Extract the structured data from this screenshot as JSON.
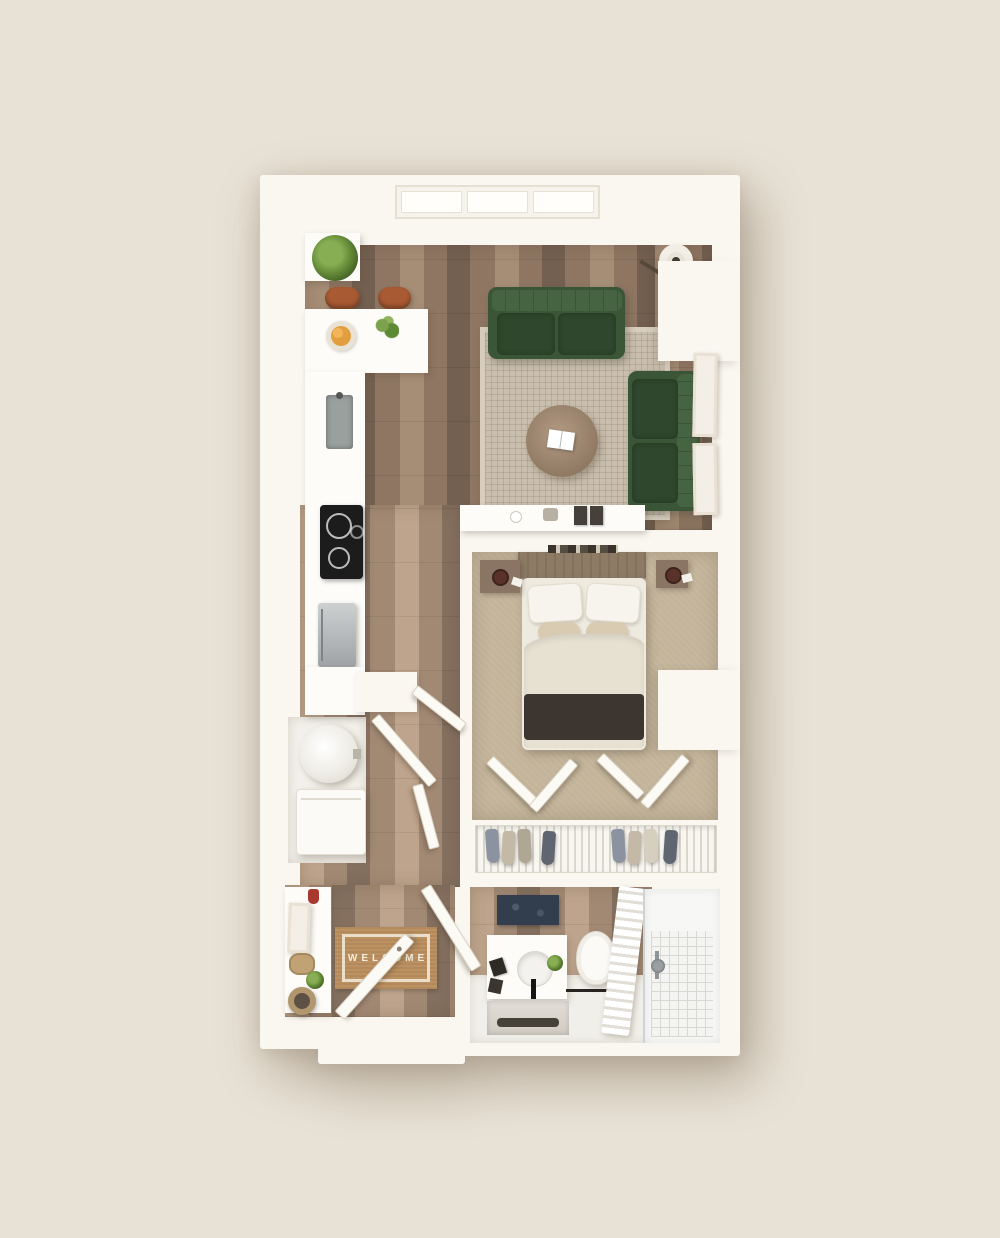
{
  "plan": {
    "type": "apartment-floor-plan-3d-render",
    "view": "top-down",
    "welcome_mat_text": "WELCOME",
    "rooms": {
      "living_room": {
        "items": [
          "three-pane window",
          "green sofa",
          "green loveseat",
          "round wood coffee table",
          "patterned area rug",
          "floor lamp",
          "media console with two framed photos",
          "two wall art frames",
          "potted plant"
        ]
      },
      "kitchen": {
        "items": [
          "peninsula island with two bar stools",
          "fruit bowl",
          "plant sprig",
          "sink",
          "black cooktop",
          "stainless refrigerator",
          "cabinet run"
        ]
      },
      "bedroom": {
        "items": [
          "queen bed with cream duvet and dark throw",
          "wood headboard",
          "two nightstands with lamps",
          "closet with bifold doors",
          "hanging clothes on wire shelf"
        ]
      },
      "bathroom": {
        "items": [
          "vanity with sink and black faucet",
          "vanity mirror",
          "navy bath mat",
          "toilet",
          "towel shelf ladder",
          "tub shower with tile floor"
        ]
      },
      "entry": {
        "items": [
          "welcome doormat",
          "front door",
          "console with leaning mirror, baskets and plant",
          "red decor"
        ]
      },
      "utility_closet": {
        "items": [
          "water heater",
          "washer dryer"
        ],
        "doors": "double doors"
      },
      "hallway": {
        "items": [
          "bedroom door",
          "bathroom door"
        ]
      }
    }
  },
  "colors": {
    "background": "#e8e1d5",
    "wall": "#faf7f1",
    "wall_shadow": "#ded5c6",
    "wood": "#8e7662",
    "wood_light": "#a68d76",
    "wood_dark": "#746050",
    "carpet": "#c3b49a",
    "rug_base": "#cabfae",
    "rug_line": "#8f8270",
    "sofa": "#3a5637",
    "sofa_dark": "#2f472c",
    "sofa_light": "#466441",
    "stool": "#a85a33",
    "counter": "#fdfcf9",
    "steel": "#b9bcbe",
    "cooktop": "#1c1c1c",
    "fruit": "#e29d3f",
    "plant": "#6d9440",
    "duvet": "#e7e1d2",
    "blanket": "#3c3530",
    "headboard": "#8d7b66",
    "nightstand": "#8a7463",
    "navy": "#323d4e",
    "mat": "#bd9262",
    "mat_text": "#f3ecdd",
    "tile": "#f4f4f2",
    "tile_line": "#d8d7d2",
    "door": "#fcfaf5",
    "door_edge": "#d9d2c4",
    "red_decor": "#a8392e"
  }
}
